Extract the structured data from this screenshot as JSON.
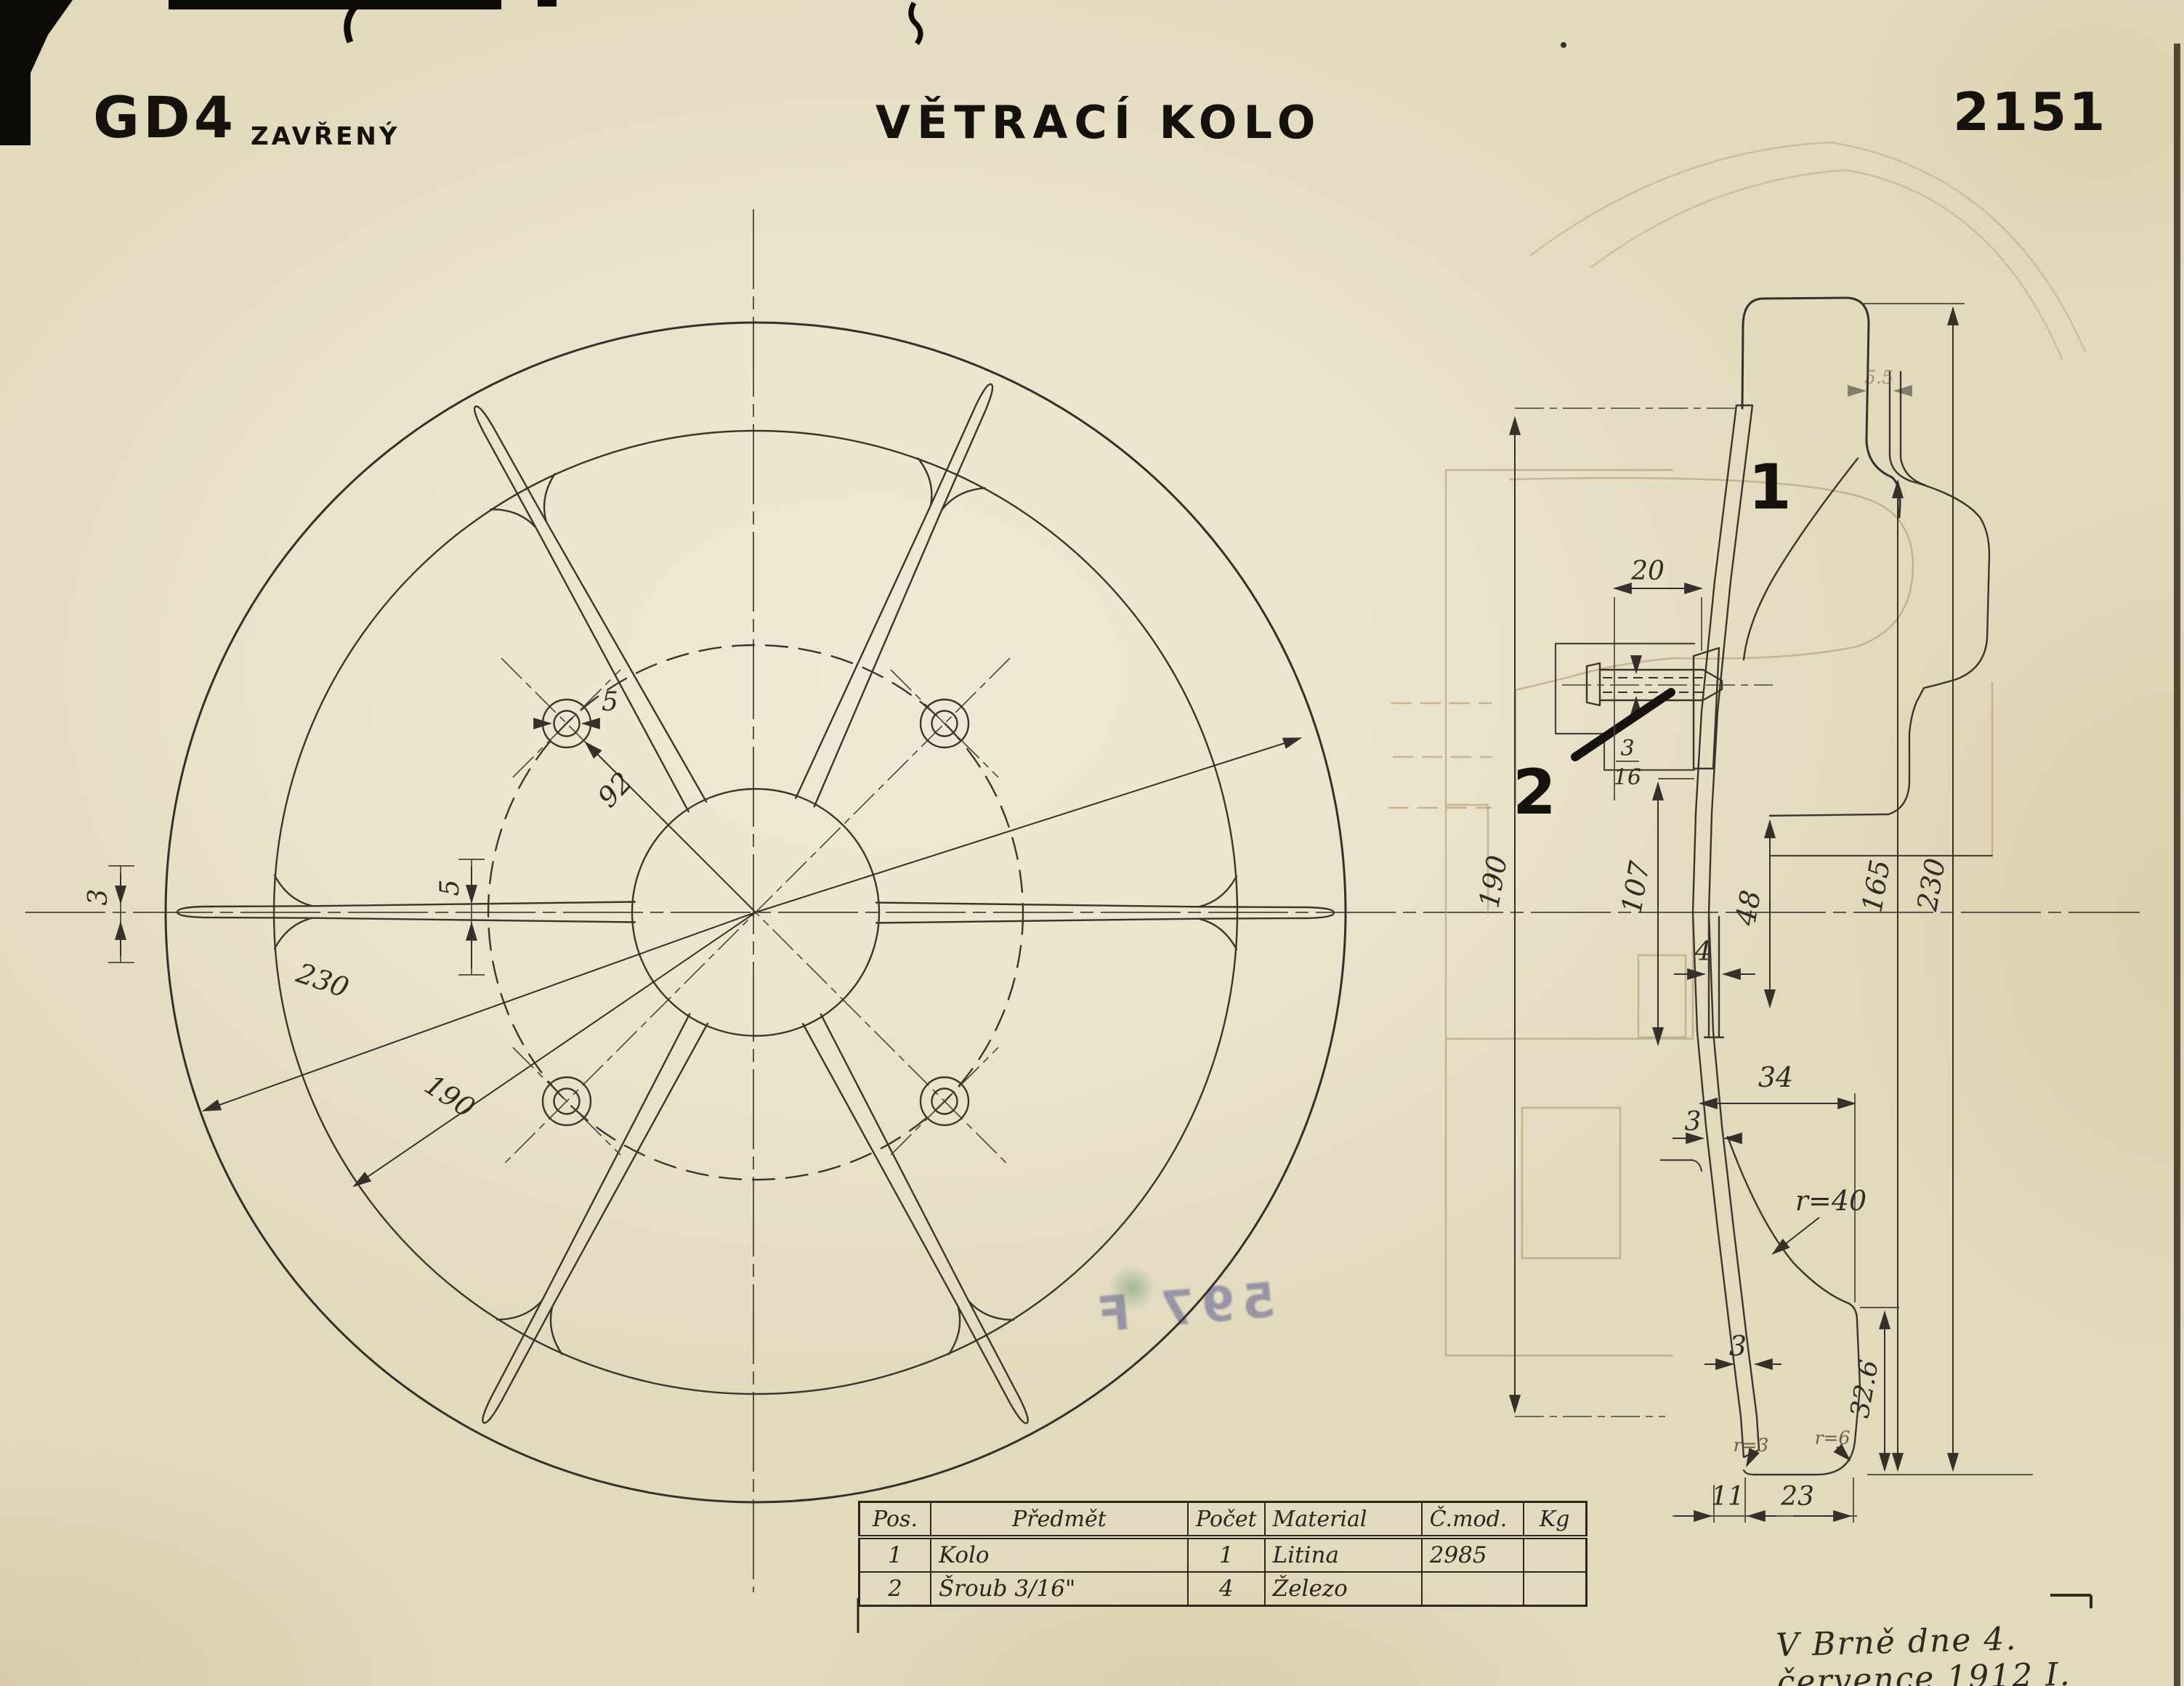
{
  "header": {
    "code": "GD4",
    "variant": "ZAVŘENÝ",
    "title": "VĚTRACÍ KOLO",
    "drawing_number": "2151"
  },
  "front_view": {
    "dim_hole": "5",
    "dim_bolt_circle": "92",
    "dim_outer_radius": "230",
    "dim_inner_radius": "190",
    "dim_blade_tip_thickness": "3",
    "dim_blade_thickness": "5"
  },
  "section_view": {
    "part_wheel": "1",
    "part_screw": "2",
    "dim_hub_depth": "20",
    "thread_num": "3",
    "thread_den": "16",
    "dim_d190": "190",
    "dim_d107": "107",
    "dim_d48": "48",
    "dim_d165": "165",
    "dim_d230": "230",
    "dim_wall": "4",
    "dim_w34": "34",
    "dim_t3_upper": "3",
    "dim_t3_lower": "3",
    "dim_r40": "r=40",
    "dim_r3": "r=3",
    "dim_r6": "r=6",
    "dim_w11": "11",
    "dim_w23": "23",
    "dim_h326": "32.6",
    "dim_gap": "5.5"
  },
  "table": {
    "headers": [
      "Pos.",
      "Předmět",
      "Počet",
      "Material",
      "Č.mod.",
      "Kg"
    ],
    "rows": [
      [
        "1",
        "Kolo",
        "1",
        "Litina",
        "2985",
        ""
      ],
      [
        "2",
        "Šroub 3/16\"",
        "4",
        "Železo",
        "",
        ""
      ]
    ]
  },
  "footer": {
    "date_note": "V Brně dne 4. července 1912 I."
  },
  "stamp": {
    "text": "597 F"
  },
  "colors": {
    "ink": "#35302a",
    "pencil": "#b1946c",
    "paper": "#eae4cc",
    "stamp_blue": "#48488a"
  }
}
